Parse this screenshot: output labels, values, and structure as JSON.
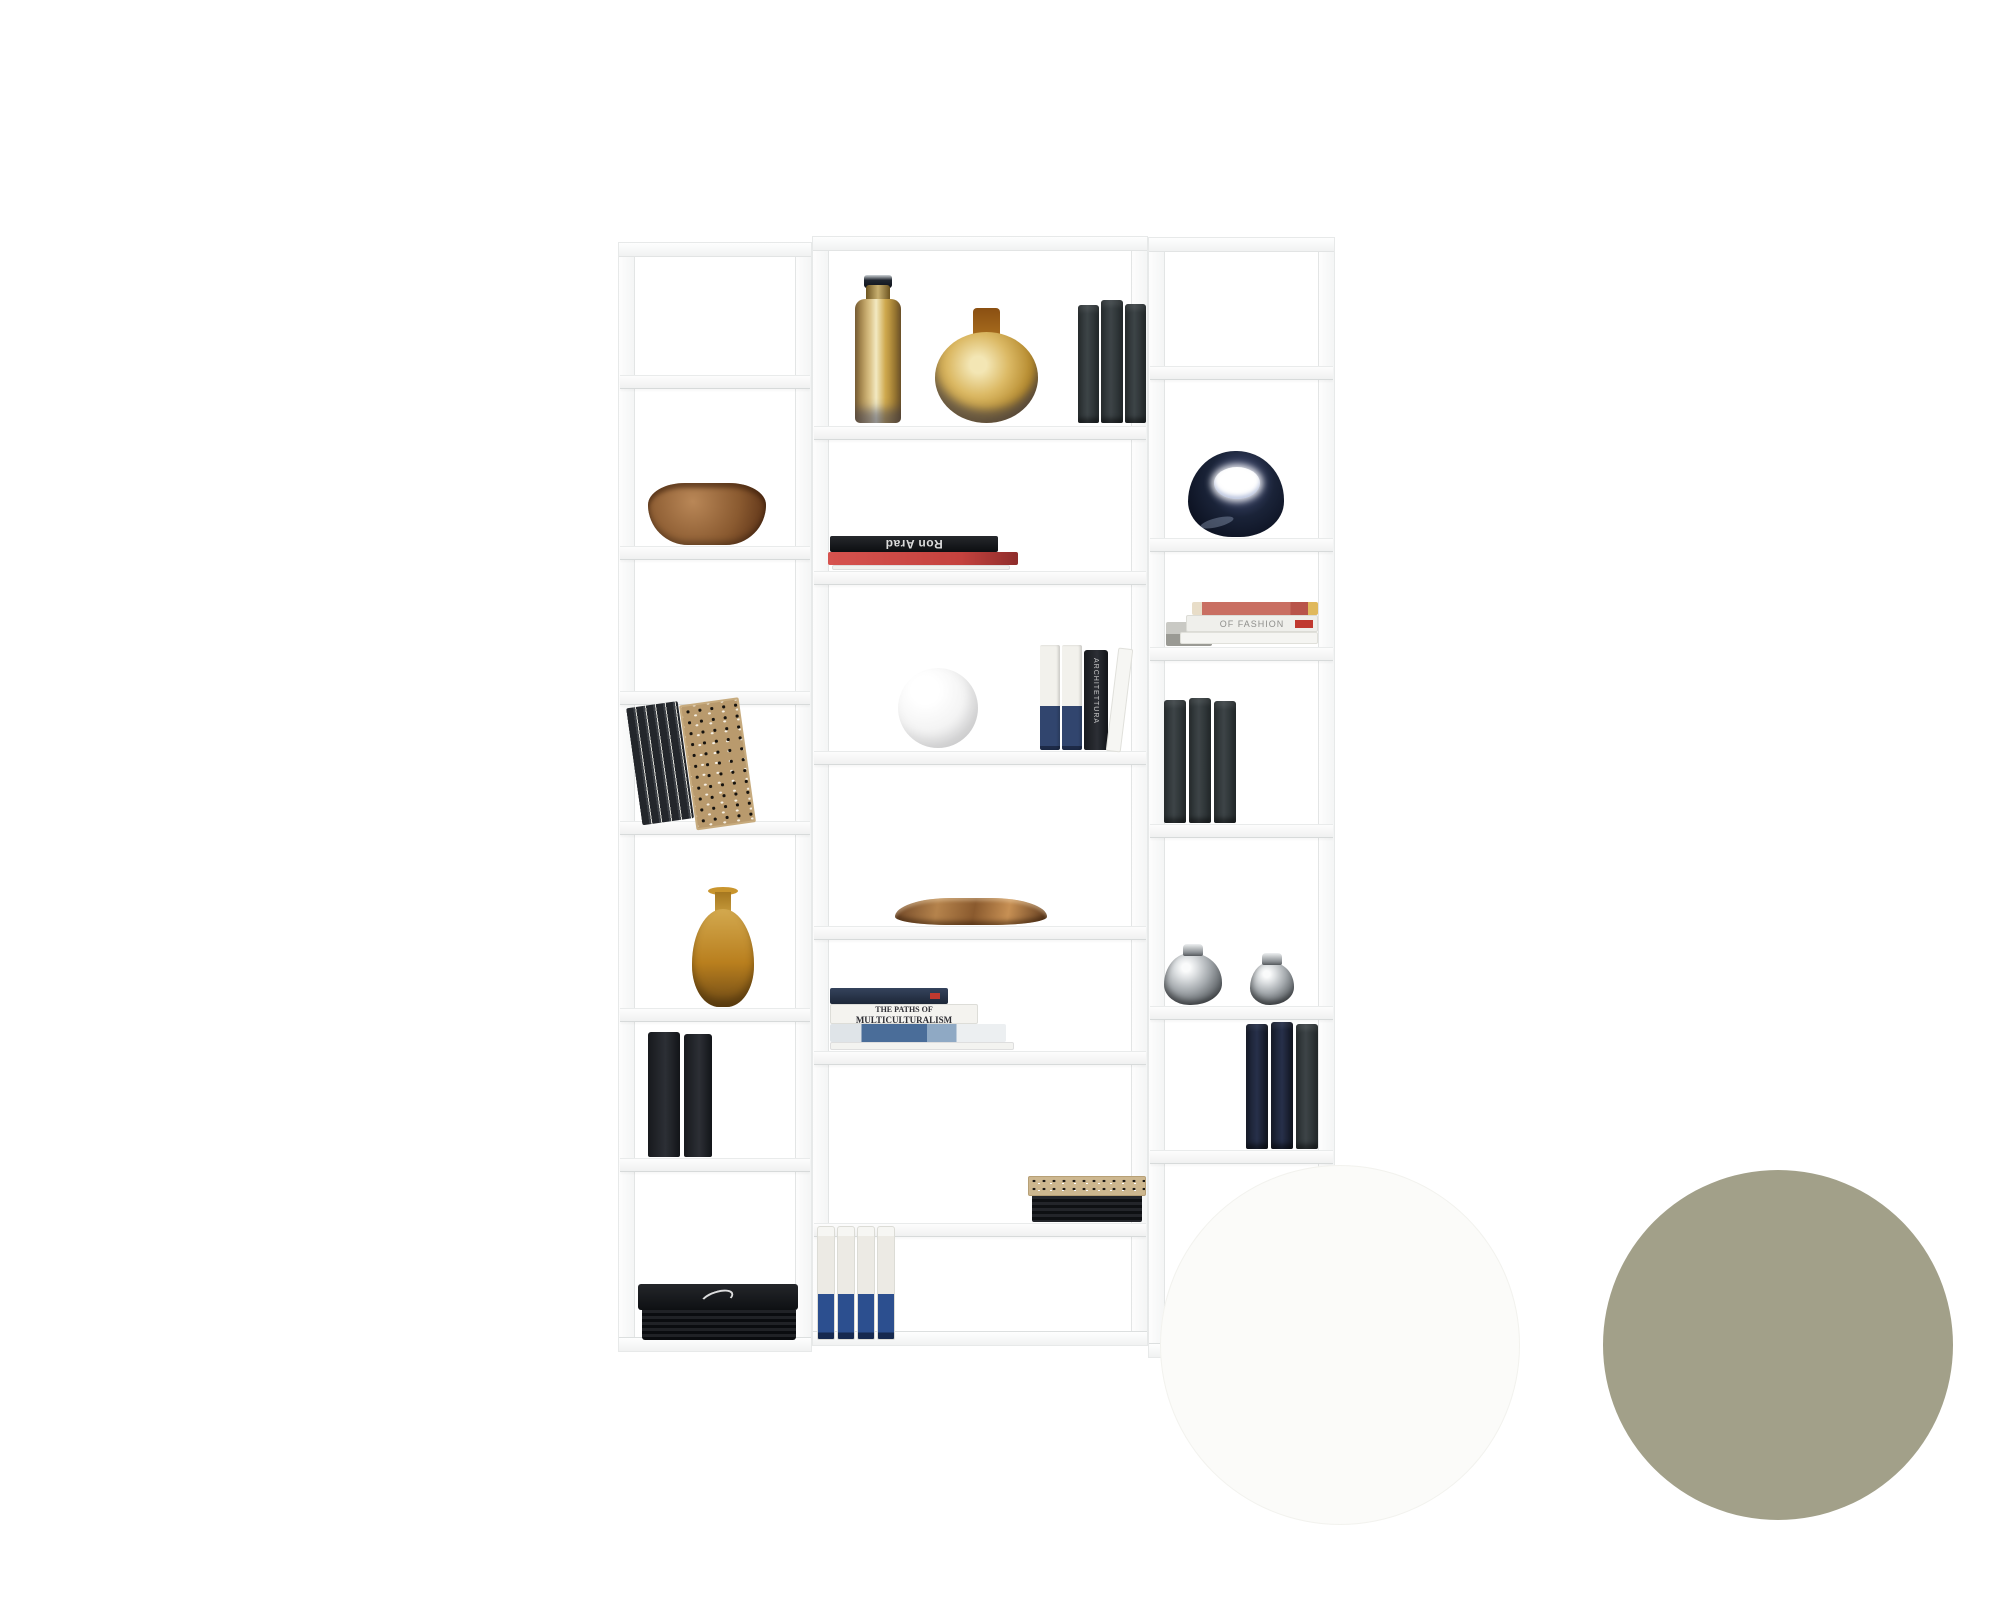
{
  "image": {
    "width": 2000,
    "height": 1600,
    "background": "#ffffff",
    "description": "Product photo of a tall white corner shelving unit styled with decor objects, with two finish colour swatches at lower right"
  },
  "shelf": {
    "frame_color": "#fcfcfc",
    "edge_color": "#e4e6e6",
    "columns": [
      {
        "id": "left",
        "compartments": [
          {
            "n": 1,
            "items": []
          },
          {
            "n": 2,
            "items": [
              "wooden-bowl"
            ]
          },
          {
            "n": 3,
            "items": []
          },
          {
            "n": 4,
            "items": [
              "leaning-dark-books",
              "carved-pattern-bookend"
            ]
          },
          {
            "n": 5,
            "items": [
              "amber-teardrop-vase"
            ]
          },
          {
            "n": 6,
            "items": [
              "black-books-pair"
            ]
          },
          {
            "n": 7,
            "items": [
              "black-portfolio-stack"
            ]
          }
        ]
      },
      {
        "id": "center",
        "compartments": [
          {
            "n": 1,
            "items": [
              "amber-glass-bottle",
              "amber-round-vase",
              "grey-cloth-books"
            ]
          },
          {
            "n": 2,
            "items": [
              "ron-arad-book-stack"
            ]
          },
          {
            "n": 3,
            "items": [
              "white-sphere",
              "blue-white-paperbacks",
              "black-architecture-book",
              "leaning-white-book"
            ]
          },
          {
            "n": 4,
            "items": [
              "wooden-tray"
            ]
          },
          {
            "n": 5,
            "items": [
              "multiculturalism-book-stack"
            ]
          },
          {
            "n": 6,
            "items": [
              "patterned-magazine-stack"
            ]
          },
          {
            "n": 7,
            "items": [
              "white-blue-binders"
            ]
          }
        ]
      },
      {
        "id": "right",
        "compartments": [
          {
            "n": 1,
            "items": []
          },
          {
            "n": 2,
            "items": [
              "navy-ceramic-pebble-vase"
            ]
          },
          {
            "n": 3,
            "items": [
              "fashion-book-stack"
            ]
          },
          {
            "n": 4,
            "items": [
              "grey-cloth-books"
            ]
          },
          {
            "n": 5,
            "items": [
              "silver-metal-vases"
            ]
          },
          {
            "n": 6,
            "items": [
              "navy-books"
            ]
          },
          {
            "n": 7,
            "items": []
          }
        ]
      }
    ]
  },
  "books": {
    "ron_arad": "Ron Arad",
    "multi_line1": "THE PATHS OF",
    "multi_line2": "MULTICULTURALISM",
    "fashion": "OF FASHION",
    "architettura": "ARCHITETTURA"
  },
  "swatches": [
    {
      "name": "white",
      "hex": "#fbfbf9"
    },
    {
      "name": "olive-grey",
      "hex": "#a2a089"
    }
  ],
  "palette": {
    "amber_light": "#ecd9a4",
    "amber_dark": "#7d5a1e",
    "wood": "#8a5a30",
    "navy": "#161c2b",
    "chrome": "#c7cacd",
    "black_book": "#1e2125",
    "binder_blue": "#2c4f8f",
    "red_book": "#c4423e"
  }
}
